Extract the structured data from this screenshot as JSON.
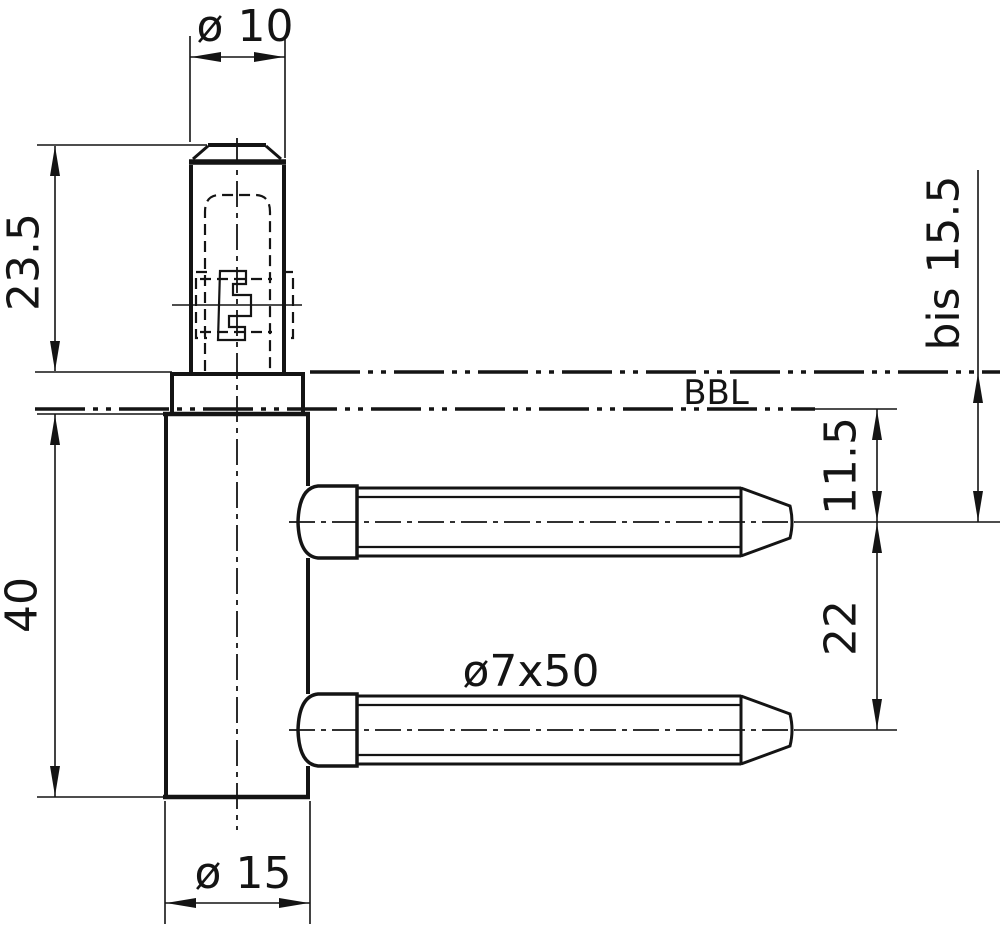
{
  "drawing": {
    "type": "technical-drawing",
    "subject": "door hinge frame part with two wood screws, side view",
    "labels": {
      "pin_diameter": "ø 10",
      "pin_height": "23.5",
      "adjustment_height": "bis 15.5",
      "reference_line": "BBL",
      "bbl_to_first_screw": "11.5",
      "screw_spacing": "22",
      "screw_spec": "ø7x50",
      "sleeve_diameter": "ø 15",
      "sleeve_length": "40"
    },
    "colors": {
      "line": "#141414",
      "background": "#ffffff"
    }
  }
}
